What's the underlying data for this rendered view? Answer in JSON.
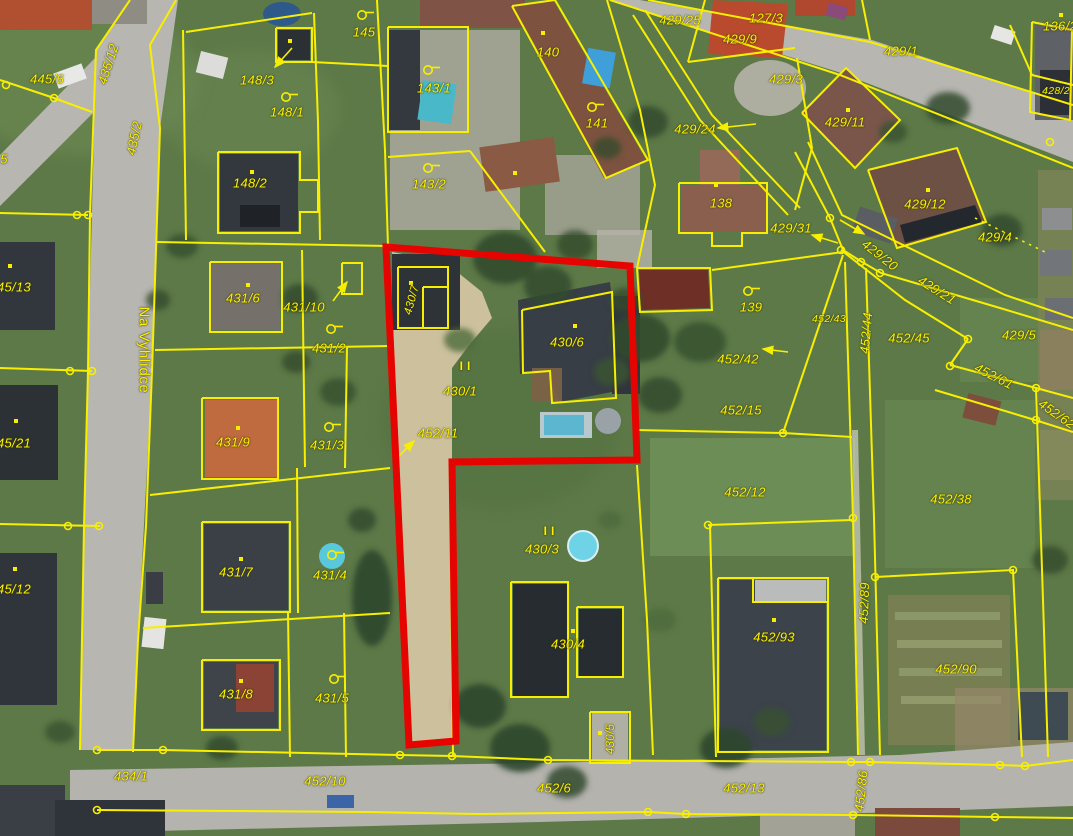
{
  "map_title": "cadastral-aerial-map",
  "palette": {
    "parcel_line": "#f8ef00",
    "parcel_text": "#fcf200",
    "highlight": "#e60400",
    "road": "#b7b6b1",
    "gravel_path": "#cdc19d",
    "grass": "#5d7947"
  },
  "street": {
    "name": "Na Vyhlídce",
    "x": 144,
    "y": 350,
    "rot": 90
  },
  "labels": [
    [
      "445/6",
      47,
      79,
      0
    ],
    [
      "435/12",
      108,
      64,
      -72
    ],
    [
      "435/2",
      134,
      138,
      -78
    ],
    [
      "5",
      4,
      159,
      0
    ],
    [
      "45/13",
      14,
      287,
      0
    ],
    [
      "45/21",
      14,
      443,
      0
    ],
    [
      "45/12",
      14,
      589,
      0
    ],
    [
      "148/3",
      257,
      80,
      0
    ],
    [
      "148/1",
      287,
      112,
      0
    ],
    [
      "148/2",
      250,
      183,
      0
    ],
    [
      "145",
      364,
      32,
      0
    ],
    [
      "143/1",
      434,
      88,
      0
    ],
    [
      "143/2",
      429,
      184,
      0
    ],
    [
      "140",
      548,
      52,
      0
    ],
    [
      "141",
      597,
      123,
      0
    ],
    [
      "429/25",
      680,
      20,
      0
    ],
    [
      "127/3",
      766,
      18,
      0
    ],
    [
      "429/9",
      740,
      39,
      0
    ],
    [
      "429/1",
      901,
      51,
      0
    ],
    [
      "136/2",
      1060,
      26,
      0
    ],
    [
      "429/3",
      786,
      79,
      0
    ],
    [
      "429/24",
      695,
      129,
      0
    ],
    [
      "429/11",
      845,
      122,
      0
    ],
    [
      "428/2",
      1056,
      91,
      0,
      10.5
    ],
    [
      "429/12",
      925,
      204,
      0
    ],
    [
      "429/31",
      791,
      228,
      0
    ],
    [
      "429/4",
      995,
      237,
      0
    ],
    [
      "138",
      721,
      203,
      0
    ],
    [
      "139",
      751,
      307,
      0
    ],
    [
      "429/20",
      880,
      255,
      38
    ],
    [
      "429/21",
      937,
      290,
      32
    ],
    [
      "429/5",
      1019,
      335,
      0
    ],
    [
      "452/43",
      829,
      319,
      0,
      10.5
    ],
    [
      "452/42",
      738,
      359,
      0
    ],
    [
      "452/44",
      866,
      333,
      -85
    ],
    [
      "452/45",
      909,
      338,
      0
    ],
    [
      "452/61",
      994,
      376,
      27
    ],
    [
      "452/62",
      1057,
      414,
      35
    ],
    [
      "431/6",
      243,
      298,
      0
    ],
    [
      "431/10",
      304,
      307,
      0
    ],
    [
      "431/2",
      329,
      348,
      0
    ],
    [
      "431/3",
      327,
      445,
      0
    ],
    [
      "431/9",
      233,
      442,
      0
    ],
    [
      "430/7",
      412,
      300,
      -75,
      11.5
    ],
    [
      "430/1",
      460,
      391,
      0
    ],
    [
      "452/11",
      438,
      433,
      0
    ],
    [
      "430/6",
      567,
      342,
      0
    ],
    [
      "452/15",
      741,
      410,
      0
    ],
    [
      "452/12",
      745,
      492,
      0
    ],
    [
      "452/38",
      951,
      499,
      0
    ],
    [
      "430/3",
      542,
      549,
      0
    ],
    [
      "430/4",
      568,
      644,
      0
    ],
    [
      "431/4",
      330,
      575,
      0
    ],
    [
      "431/7",
      236,
      572,
      0
    ],
    [
      "431/8",
      236,
      694,
      0
    ],
    [
      "431/5",
      332,
      698,
      0
    ],
    [
      "430/5",
      611,
      739,
      -90,
      11.5
    ],
    [
      "452/93",
      774,
      637,
      0
    ],
    [
      "452/89",
      864,
      603,
      -88
    ],
    [
      "452/90",
      956,
      669,
      0
    ],
    [
      "434/1",
      131,
      776,
      0
    ],
    [
      "452/10",
      325,
      781,
      0
    ],
    [
      "452/6",
      554,
      788,
      0
    ],
    [
      "452/13",
      744,
      788,
      0
    ],
    [
      "452/86",
      861,
      791,
      -84
    ]
  ],
  "roman_marks": [
    [
      "II",
      467,
      366
    ],
    [
      "II",
      551,
      531
    ]
  ],
  "flag_markers": [
    [
      362,
      15
    ],
    [
      428,
      70
    ],
    [
      428,
      168
    ],
    [
      592,
      107
    ],
    [
      286,
      97
    ],
    [
      331,
      329
    ],
    [
      329,
      427
    ],
    [
      332,
      555
    ],
    [
      334,
      679
    ],
    [
      748,
      291
    ]
  ],
  "node_markers": [
    [
      6,
      85
    ],
    [
      54,
      98
    ],
    [
      77,
      215
    ],
    [
      88,
      215
    ],
    [
      70,
      371
    ],
    [
      92,
      371
    ],
    [
      68,
      526
    ],
    [
      99,
      526
    ],
    [
      97,
      750
    ],
    [
      163,
      750
    ],
    [
      97,
      810
    ],
    [
      400,
      755
    ],
    [
      452,
      756
    ],
    [
      548,
      760
    ],
    [
      648,
      812
    ],
    [
      686,
      814
    ],
    [
      851,
      762
    ],
    [
      870,
      762
    ],
    [
      853,
      815
    ],
    [
      1000,
      765
    ],
    [
      1025,
      766
    ],
    [
      995,
      817
    ],
    [
      830,
      218
    ],
    [
      841,
      250
    ],
    [
      861,
      262
    ],
    [
      880,
      273
    ],
    [
      968,
      339
    ],
    [
      950,
      366
    ],
    [
      1036,
      388
    ],
    [
      1036,
      420
    ],
    [
      783,
      433
    ],
    [
      708,
      525
    ],
    [
      853,
      518
    ],
    [
      875,
      577
    ],
    [
      1013,
      570
    ],
    [
      1050,
      142
    ]
  ],
  "dot_markers": [
    [
      290,
      41
    ],
    [
      252,
      172
    ],
    [
      543,
      33
    ],
    [
      515,
      173
    ],
    [
      848,
      110
    ],
    [
      928,
      190
    ],
    [
      716,
      185
    ],
    [
      411,
      283
    ],
    [
      575,
      326
    ],
    [
      248,
      285
    ],
    [
      238,
      428
    ],
    [
      241,
      559
    ],
    [
      241,
      681
    ],
    [
      10,
      266
    ],
    [
      16,
      421
    ],
    [
      15,
      569
    ],
    [
      573,
      631
    ],
    [
      774,
      620
    ],
    [
      600,
      733
    ],
    [
      1061,
      15
    ]
  ],
  "arrows": [
    [
      292,
      48,
      275,
      67
    ],
    [
      333,
      301,
      347,
      282
    ],
    [
      756,
      124,
      718,
      128
    ],
    [
      838,
      243,
      812,
      235
    ],
    [
      840,
      220,
      864,
      234
    ],
    [
      788,
      352,
      763,
      349
    ],
    [
      399,
      456,
      414,
      441
    ]
  ],
  "highlight": {
    "points": "386,247 630,266 637,460 452,462 456,741 409,745"
  }
}
